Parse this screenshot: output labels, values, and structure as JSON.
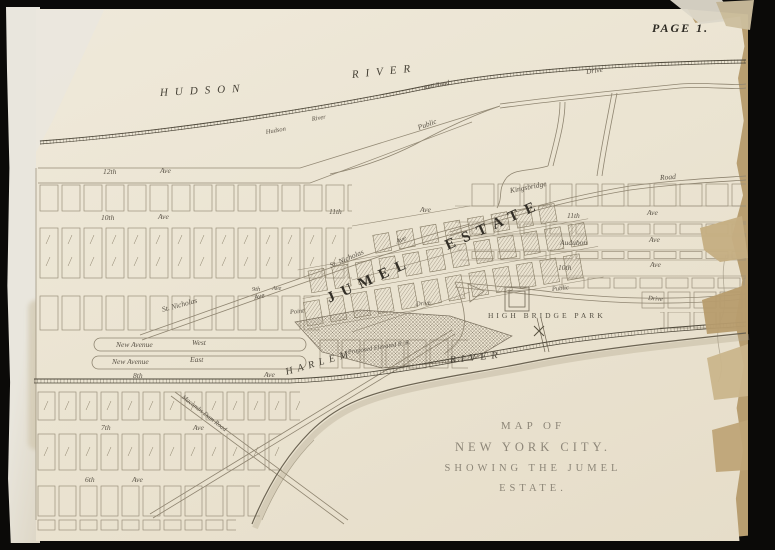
{
  "page": {
    "number": "PAGE 1."
  },
  "title": {
    "line1": "MAP OF",
    "line2": "NEW YORK CITY.",
    "line3": "SHOWING THE JUMEL ESTATE."
  },
  "waters": {
    "hudson_1": "HUDSON",
    "hudson_2": "RIVER",
    "harlem_1": "HARLEM",
    "harlem_2": "RIVER"
  },
  "estate": {
    "name": "JUMEL ESTATE"
  },
  "park": {
    "name": "HIGH BRIDGE PARK"
  },
  "railroads": {
    "hudson_rr_1": "Hudson",
    "hudson_rr_2": "River",
    "hudson_rr_3": "Rail Road",
    "elevated": "Proposed Elevated R. R."
  },
  "roads": {
    "public_top": "Public",
    "drive_top": "Drive",
    "public_park": "Public",
    "drive_park": "Drive",
    "drive_estate": "Drive",
    "point": "Point",
    "kingsbridge_1": "Kingsbridge",
    "kingsbridge_2": "Road",
    "st_nicholas_1": "St. Nicholas",
    "st_nicholas_1_ave": "Ave",
    "st_nicholas_2": "St. Nicholas",
    "st_nicholas_2_ave": "Ave",
    "new_ave_west_1": "New Avenue",
    "new_ave_west_2": "West",
    "new_ave_east_1": "New Avenue",
    "new_ave_east_2": "East",
    "macombs": "Macombs Dam Road"
  },
  "avenues": {
    "a12": "12th",
    "a12_ave": "Ave",
    "a10l": "10th",
    "a10l_ave": "Ave",
    "a11c": "11th",
    "a11c_ave": "Ave",
    "a9": "9th",
    "a9_ave": "Ave",
    "a8": "8th",
    "a8_ave": "Ave",
    "a7": "7th",
    "a7_ave": "Ave",
    "a6": "6th",
    "a6_ave": "Ave",
    "a11r": "11th",
    "a11r_ave": "Ave",
    "audubon": "Audubon",
    "audubon_ave": "Ave",
    "a10r": "10th",
    "a10r_ave": "Ave"
  },
  "colors": {
    "paper": "#ebe4d2",
    "ink": "#6e6656",
    "label": "#5a5347",
    "title_gray": "#8d8678",
    "tape": "#b89e70",
    "border": "#0b0a08"
  }
}
